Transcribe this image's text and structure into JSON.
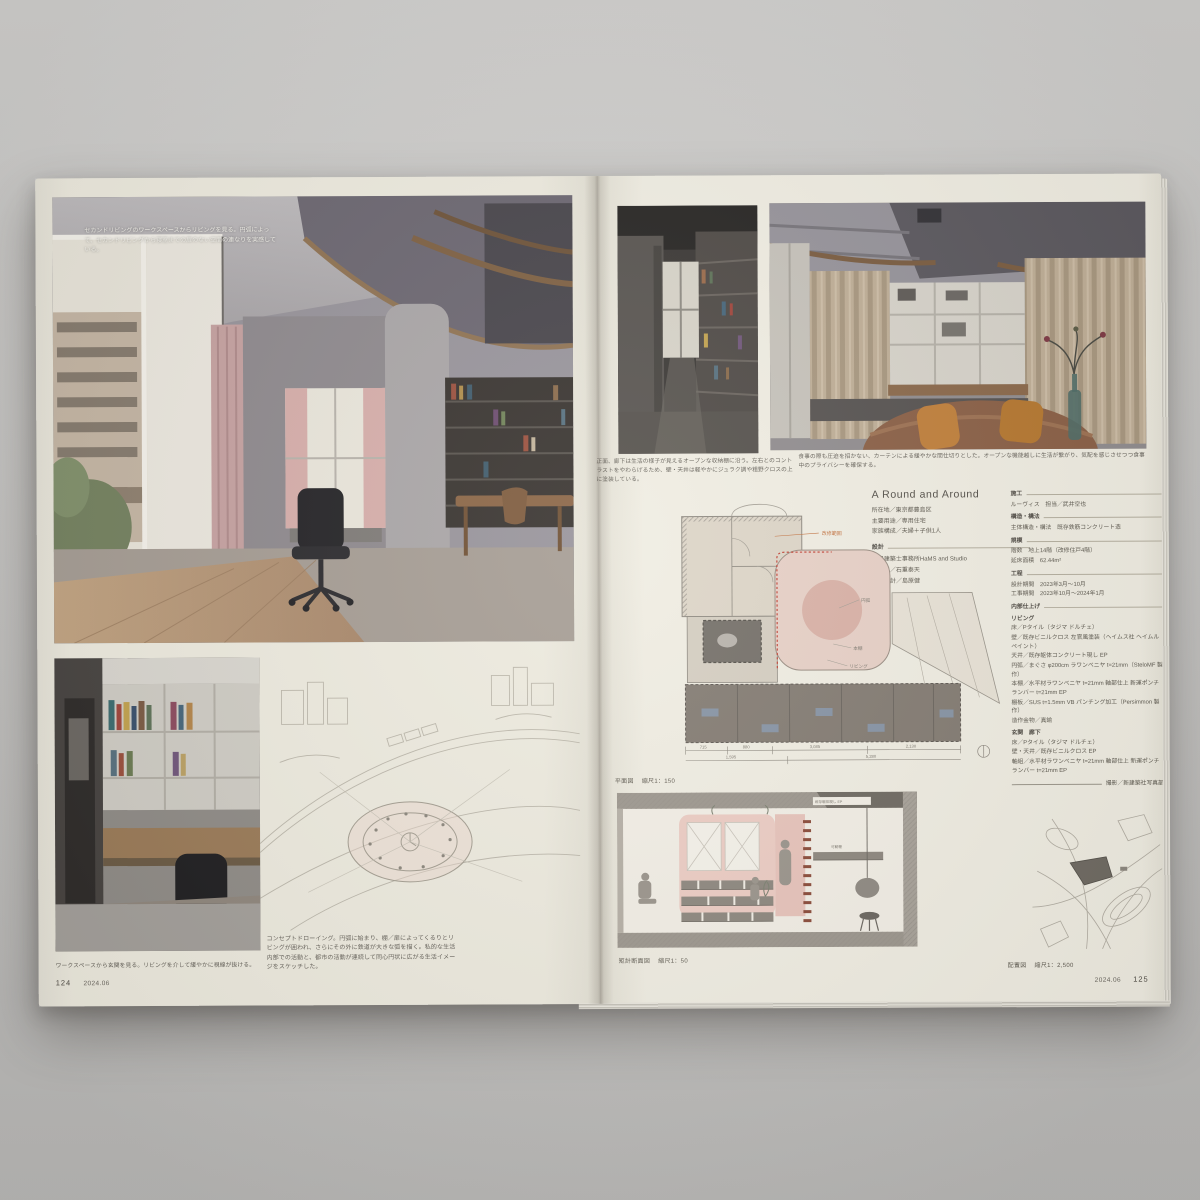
{
  "issue": "2024.06",
  "left_page": {
    "page_number": "124",
    "photo_caption_overlay": "セカンドリビングのワークスペースからリビングを見る。円弧によって、セカンドリビングから寝室までの扉のない空間の連なりを実感している。",
    "bottom_photo_caption": "ワークスペースから玄関を見る。リビングを介して緩やかに視線が抜ける。",
    "sketch_caption": "コンセプトドローイング。円弧に始まり、棚／扉によってくるりとリビングが囲われ、さらにその外に鉄道が大きな弧を描く。私的な生活内部での活動と、都市の活動が連続して同心円状に広がる生活イメージをスケッチした。"
  },
  "right_page": {
    "page_number": "125",
    "corridor_caption": "正面、廊下は生活の様子が見えるオープンな収納棚に沿う。左右とのコントラストをやわらげるため、壁・天井は軽やかにジュラク調や粗野クロスの上に塗装している。",
    "living_caption": "食事の際も圧迫を招かない、カーテンによる緩やかな間仕切りとした。オープンな機能越しに生活が繋がり、気配を感じさせつつ食事中のプライバシーを確保する。",
    "project": {
      "title": "A Round and Around",
      "location": "所在地／東京都豊島区",
      "use": "主要用途／専用住宅",
      "family": "家族構成／夫婦＋子供1人",
      "design_header": "設計",
      "design_firm": "一級建築士事務所HaMS and Studio",
      "design_staff": "担当／石重泰天",
      "design_collab": "協働設計／島原健"
    },
    "spec_rows": [
      {
        "v": "施工"
      },
      {
        "v": "ルーヴィス　担当／武井空也"
      },
      {
        "v": "構造・構法"
      },
      {
        "v": "主体構造・構法　既存鉄筋コンクリート造"
      },
      {
        "v": "規模"
      },
      {
        "v": "階数　地上14階（改修住戸4階）"
      },
      {
        "v": "延床面積　62.44m²"
      },
      {
        "v": "工程"
      },
      {
        "v": "設計期間　2023年3月〜10月"
      },
      {
        "v": "工事期間　2023年10月〜2024年1月"
      },
      {
        "v": "内部仕上げ"
      },
      {
        "v": "リビング"
      },
      {
        "v": "床／Pタイル（タジマ ドルチェ）"
      },
      {
        "v": "壁／既存ビニルクロス 左官風塗装（ヘイムス社 ヘイムルペイント）"
      },
      {
        "v": "天井／既存躯体コンクリート現し EP"
      },
      {
        "v": "円弧／まぐさ φ200cm ラワンベニヤ t=21mm（SteloMF 製作）"
      },
      {
        "v": "本棚／水平材ラワンベニヤ t=21mm 軸部仕上 新運ポンチランバー t=21mm EP"
      },
      {
        "v": "棚板／SUS t=1.5mm VB パンチング加工（Persimmon 製作）"
      },
      {
        "v": "造作金物／真鍮"
      },
      {
        "v": "玄関　廊下"
      },
      {
        "v": "床／Pタイル（タジマ ドルチェ）"
      },
      {
        "v": "壁・天井／既存ビニルクロス EP"
      },
      {
        "v": "軸組／水平材ラワンベニヤ t=21mm 軸部仕上 新運ポンチランバー t=21mm EP"
      },
      {
        "v": "撮影／新建築社写真部"
      }
    ],
    "plan": {
      "label": "平面図",
      "scale": "縮尺1：150",
      "annotation": "改修範囲",
      "labels": [
        "円弧",
        "本棚",
        "リビング"
      ],
      "dims": [
        "715",
        "880",
        "3,085",
        "2,130"
      ],
      "total_left": "1,595",
      "total_right": "5,280"
    },
    "section": {
      "label": "矩計断面図",
      "scale": "縮尺1：50",
      "labels": [
        "既存躯体現し EP",
        "可動棚"
      ]
    },
    "sitemap": {
      "label": "配置図",
      "scale": "縮尺1：2,500"
    }
  },
  "colors": {
    "paper": "#edeade",
    "backdrop": "#c6c5c3",
    "plan_pink": "#e7d0c6",
    "plan_red": "#c0392b",
    "annotation_orange": "#c2703d"
  }
}
